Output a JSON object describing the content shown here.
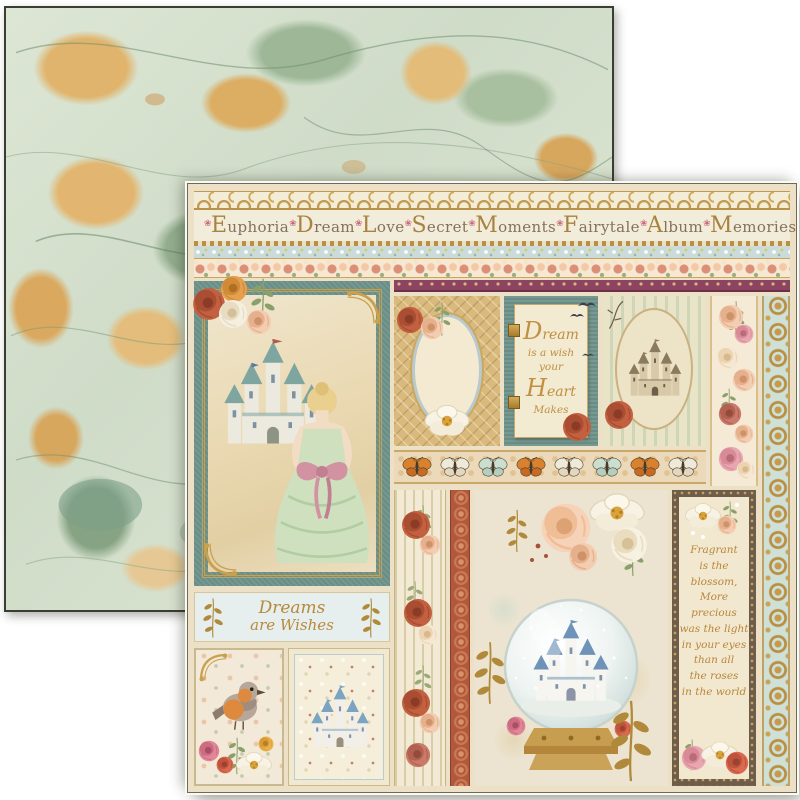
{
  "product": {
    "type": "double-sided scrapbook paper photo",
    "front_theme": "fairytale collage",
    "back_theme": "green and gold marbled paper"
  },
  "front_sheet": {
    "title_words": [
      "Euphoria",
      "Dream",
      "Love",
      "Secret",
      "Moments",
      "Fairytale",
      "Album",
      "Memories"
    ],
    "dream_quote": {
      "lines": [
        "Dream",
        "is a wish",
        "your",
        "Heart",
        "Makes"
      ]
    },
    "dreams_wishes": {
      "line1": "Dreams",
      "line2": "are Wishes"
    },
    "poem": {
      "lines": [
        "Fragrant",
        "is the",
        "blossom,",
        "More",
        "precious",
        "was the light",
        "in your eyes",
        "than all",
        "the roses",
        "in the world"
      ]
    }
  },
  "icons": {
    "flower_ornament": "❀"
  },
  "colors": {
    "teal_panel": "#6e948a",
    "gold": "#c19a4d",
    "maroon_ribbon": "#8c4460",
    "rust": "#b1583c",
    "cream": "#ece1c6",
    "sage_marble": "#cfdcc8",
    "tan_marble": "#dcae64",
    "mint_strip": "#cfe0d6",
    "peach_rose": "#f3cdb2",
    "poem_text": "#b8863b"
  }
}
